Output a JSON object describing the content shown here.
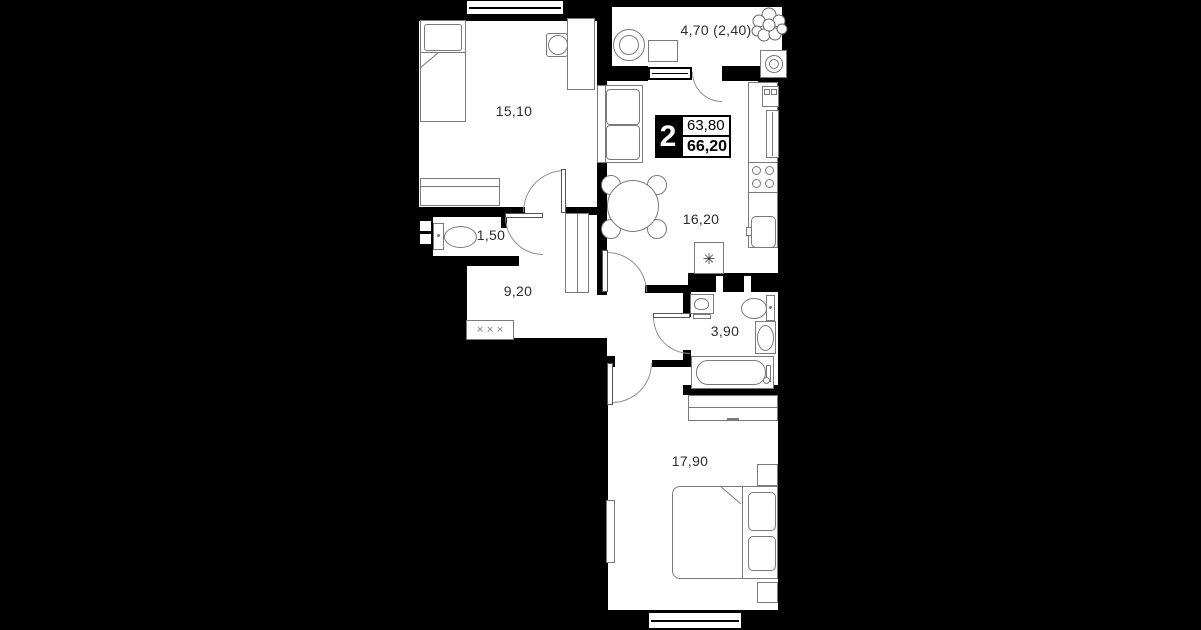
{
  "plan_type": "apartment-floor-plan",
  "badge": {
    "rooms_count": "2",
    "area_top": "63,80",
    "area_bottom": "66,20"
  },
  "rooms": {
    "bedroom1": {
      "area": "15,10"
    },
    "balcony": {
      "area": "4,70 (2,40)"
    },
    "kitchen": {
      "area": "16,20"
    },
    "wc": {
      "area": "1,50"
    },
    "hallway": {
      "area": "9,20"
    },
    "bathroom": {
      "area": "3,90"
    },
    "bedroom2": {
      "area": "17,90"
    }
  },
  "symbols": {
    "fridge": "✳",
    "coat_rack": "✕ ✕ ✕"
  },
  "colors": {
    "background": "#000000",
    "walls": "#000000",
    "floor": "#ffffff",
    "furniture_stroke": "#7a7a7a",
    "label_text": "#2d2d2d",
    "badge_bg": "#000000",
    "badge_text": "#ffffff"
  }
}
